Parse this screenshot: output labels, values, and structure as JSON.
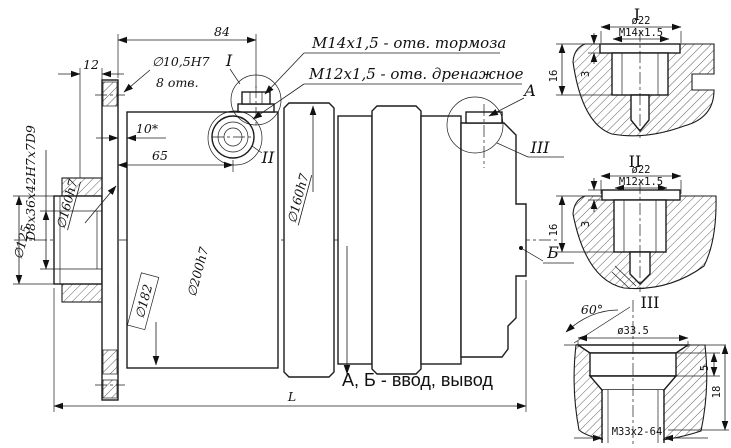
{
  "drawing": {
    "main_view": {
      "annotations": {
        "brake_port": "M14x1,5 -  отв. тормоза",
        "drain_port": "M12x1,5 -  отв. дренажное",
        "ports_note": "А, Б - ввод, вывод",
        "label_a": "А",
        "label_b": "Б",
        "detail_ref_1": "I",
        "detail_ref_2": "II",
        "detail_ref_3": "III"
      },
      "dimensions": {
        "length_84": "84",
        "width_12": "12",
        "bolt_hole_dia": "∅10,5H7",
        "bolt_hole_count": "8 отв.",
        "lip_10": "10*",
        "length_65": "65",
        "spline": "D8x36x42H7x7D9",
        "dia_160_left": "∅160h7",
        "dia_125": "∅125",
        "dia_182_ref": "∅182",
        "dia_200": "∅200h7",
        "dia_160_mid": "∅160h7",
        "overall_length": "L"
      }
    },
    "detail_1": {
      "title": "I",
      "dia": "ø22",
      "thread": "M14x1.5",
      "depth_total": "16",
      "head_depth": "3"
    },
    "detail_2": {
      "title": "II",
      "dia": "ø22",
      "thread": "M12x1.5",
      "depth_total": "16",
      "head_depth": "3"
    },
    "detail_3": {
      "title": "III",
      "angle": "60°",
      "dia": "ø33.5",
      "counterbore_depth": "5",
      "depth_total": "18",
      "thread": "M33x2-64"
    }
  },
  "colors": {
    "line": "#1c1c1c",
    "background": "#ffffff"
  }
}
